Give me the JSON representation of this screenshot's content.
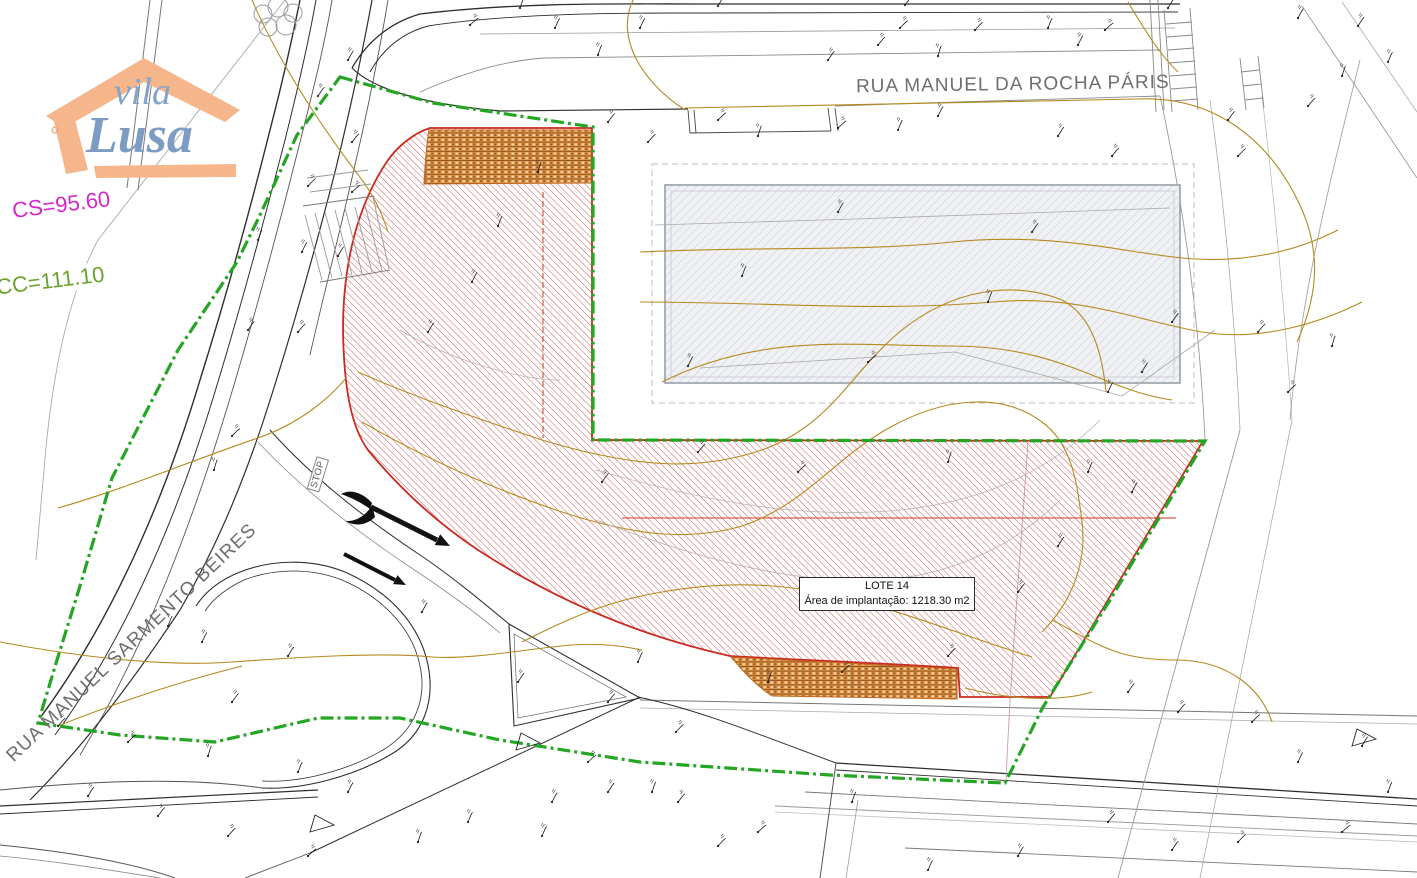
{
  "plan": {
    "logo": {
      "word1": "vila",
      "word2": "Lusa"
    },
    "annotations": {
      "cs_label": "CS=95.60",
      "cc_label": "CC=111.10",
      "street_top": "RUA MANUEL DA ROCHA PÁRIS",
      "street_left": "RUA MANUEL SARMENTO BEIRES",
      "stop_marking": "STOP"
    },
    "lot_box": {
      "title": "LOTE 14",
      "area_line": "Área de implantação: 1218.30 m2"
    },
    "colors": {
      "lot_hatch": "#d05454",
      "lot_outline": "#c92a21",
      "reservation_band": "#df9a4a",
      "boundary_green": "#24a524",
      "contour": "#b5891f",
      "cs_magenta": "#d428c8",
      "cc_green": "#6aa32c",
      "street_text": "#6e6e6e",
      "building_border": "#97a0a8",
      "road_dark": "#2e2e2e",
      "logo_orange": "#f6b68b",
      "logo_blue": "#84a3c9"
    },
    "survey_marks": [
      [
        470,
        25
      ],
      [
        520,
        8
      ],
      [
        640,
        28
      ],
      [
        718,
        6
      ],
      [
        828,
        60
      ],
      [
        878,
        45
      ],
      [
        900,
        28
      ],
      [
        938,
        56
      ],
      [
        1048,
        28
      ],
      [
        1078,
        45
      ],
      [
        1168,
        8
      ],
      [
        1228,
        120
      ],
      [
        1308,
        106
      ],
      [
        718,
        120
      ],
      [
        758,
        136
      ],
      [
        898,
        130
      ],
      [
        938,
        116
      ],
      [
        1058,
        136
      ],
      [
        608,
        122
      ],
      [
        648,
        142
      ],
      [
        838,
        128
      ],
      [
        1342,
        76
      ],
      [
        1388,
        62
      ],
      [
        1298,
        18
      ],
      [
        1358,
        26
      ],
      [
        905,
        5
      ],
      [
        975,
        30
      ],
      [
        1105,
        30
      ],
      [
        598,
        55
      ],
      [
        555,
        28
      ],
      [
        348,
        60
      ],
      [
        318,
        96
      ],
      [
        352,
        142
      ],
      [
        308,
        186
      ],
      [
        352,
        192
      ],
      [
        258,
        240
      ],
      [
        302,
        252
      ],
      [
        338,
        256
      ],
      [
        248,
        330
      ],
      [
        298,
        332
      ],
      [
        232,
        436
      ],
      [
        214,
        470
      ],
      [
        168,
        626
      ],
      [
        202,
        642
      ],
      [
        288,
        656
      ],
      [
        232,
        702
      ],
      [
        58,
        726
      ],
      [
        128,
        742
      ],
      [
        208,
        756
      ],
      [
        298,
        772
      ],
      [
        348,
        792
      ],
      [
        88,
        796
      ],
      [
        158,
        816
      ],
      [
        228,
        836
      ],
      [
        308,
        856
      ],
      [
        418,
        842
      ],
      [
        468,
        822
      ],
      [
        552,
        802
      ],
      [
        608,
        792
      ],
      [
        678,
        802
      ],
      [
        718,
        846
      ],
      [
        758,
        832
      ],
      [
        852,
        802
      ],
      [
        928,
        870
      ],
      [
        1018,
        856
      ],
      [
        1172,
        850
      ],
      [
        1108,
        822
      ],
      [
        1238,
        842
      ],
      [
        1342,
        832
      ],
      [
        1388,
        792
      ],
      [
        1298,
        762
      ],
      [
        1362,
        746
      ],
      [
        1128,
        692
      ],
      [
        1178,
        712
      ],
      [
        1252,
        722
      ],
      [
        538,
        172
      ],
      [
        498,
        226
      ],
      [
        472,
        282
      ],
      [
        428,
        332
      ],
      [
        602,
        482
      ],
      [
        698,
        452
      ],
      [
        798,
        472
      ],
      [
        948,
        462
      ],
      [
        1088,
        472
      ],
      [
        1132,
        492
      ],
      [
        1058,
        546
      ],
      [
        1018,
        592
      ],
      [
        948,
        656
      ],
      [
        842,
        672
      ],
      [
        768,
        682
      ],
      [
        638,
        662
      ],
      [
        422,
        612
      ],
      [
        518,
        682
      ],
      [
        608,
        702
      ],
      [
        676,
        732
      ],
      [
        588,
        762
      ],
      [
        652,
        792
      ],
      [
        542,
        836
      ],
      [
        838,
        212
      ],
      [
        1032,
        232
      ],
      [
        1112,
        156
      ],
      [
        1238,
        156
      ],
      [
        868,
        362
      ],
      [
        988,
        302
      ],
      [
        1108,
        392
      ],
      [
        1142,
        372
      ],
      [
        1172,
        322
      ],
      [
        1258,
        332
      ],
      [
        1288,
        392
      ],
      [
        1332,
        346
      ],
      [
        742,
        276
      ],
      [
        688,
        366
      ]
    ]
  }
}
